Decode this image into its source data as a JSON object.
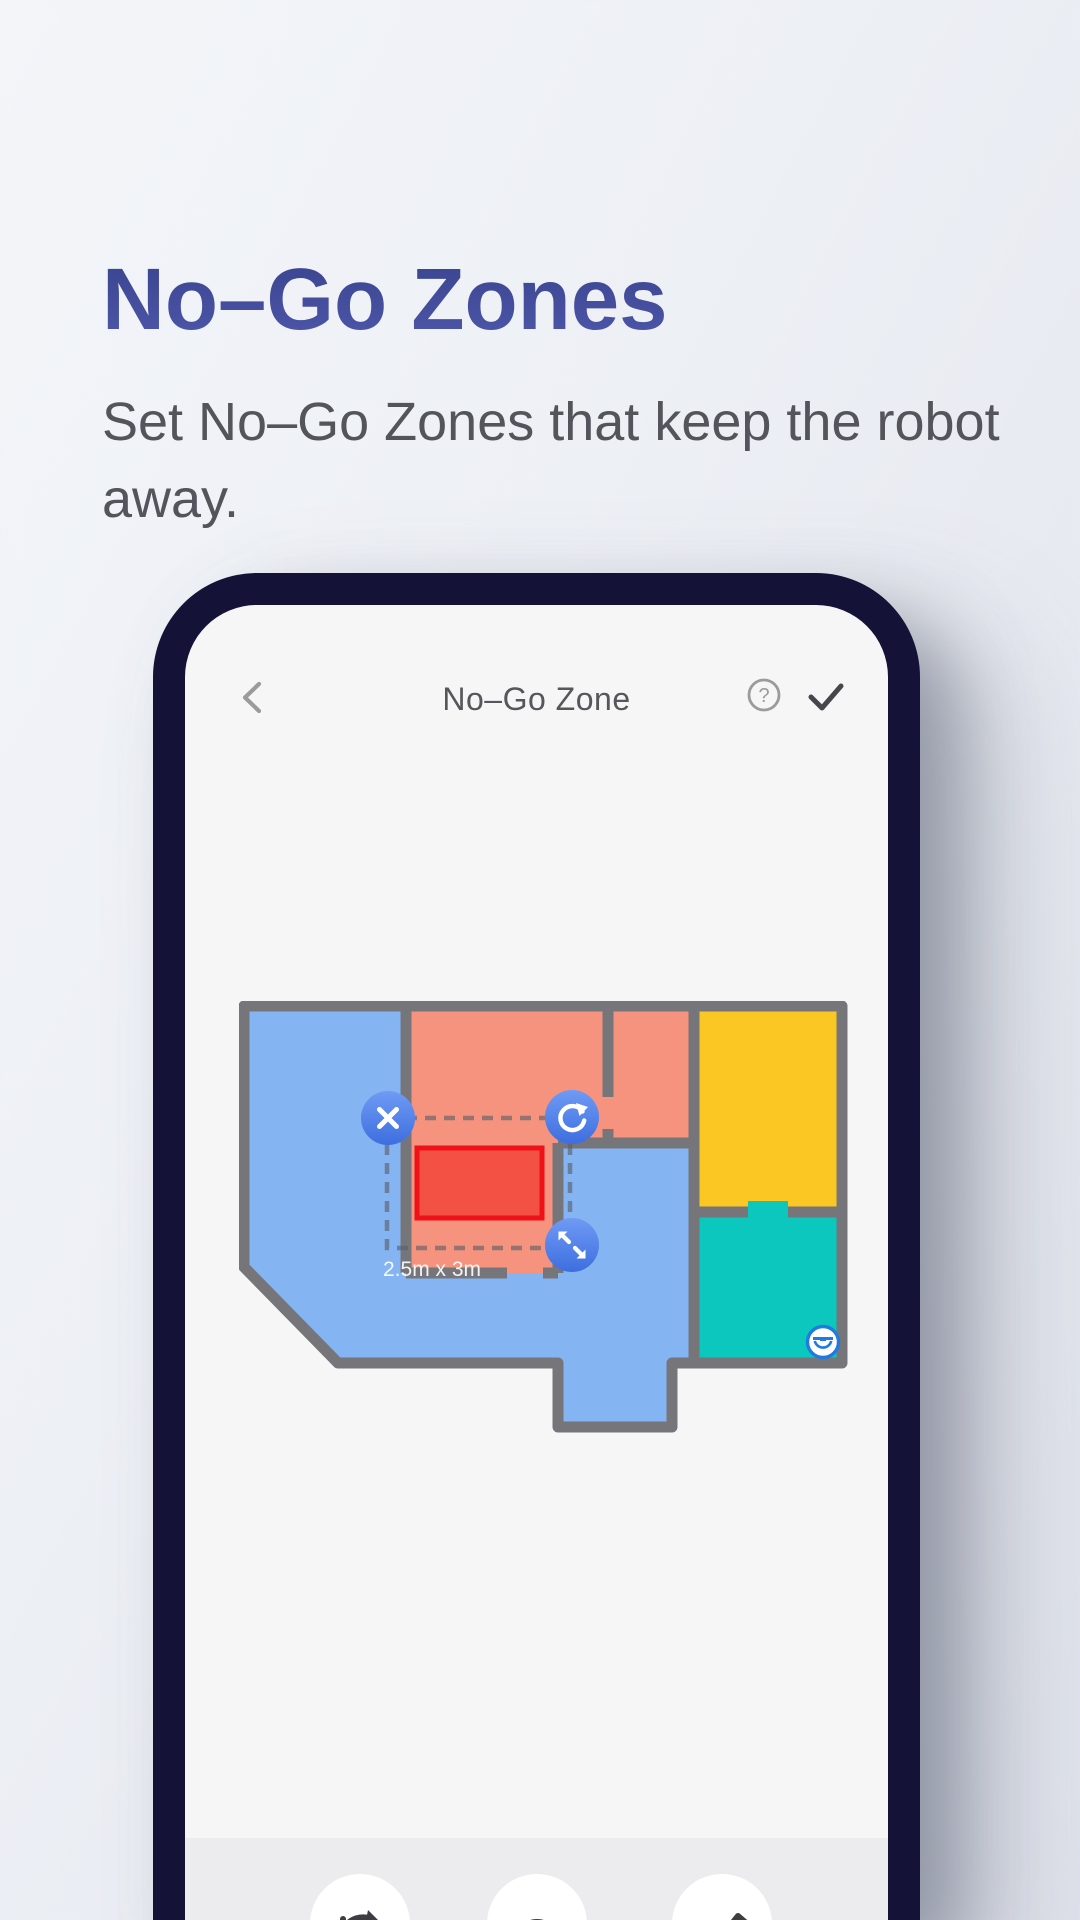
{
  "page": {
    "title": "No–Go Zones",
    "subtitle": "Set No–Go Zones that keep the robot away.",
    "colors": {
      "title_gradient_top": "#3a4590",
      "title_gradient_bottom": "#4d56a8",
      "subtitle_text": "#54555c",
      "background": "#e9ecf2"
    }
  },
  "phone": {
    "frame_color": "#141237",
    "screen_color": "#f6f6f7",
    "nav": {
      "title": "No–Go Zone",
      "back_icon": "chevron-left",
      "help_icon": "question-circle",
      "confirm_icon": "checkmark",
      "icon_color": "#9b9b9b",
      "confirm_color": "#46464b"
    },
    "map": {
      "wall_color": "#76767a",
      "rooms": {
        "living": "#84b4f1",
        "bedroom": "#f6937e",
        "study": "#fac723",
        "bathroom": "#0cc7bd"
      },
      "zone": {
        "label": "2.5m x 3m",
        "fill": "#f24b3e",
        "border": "#ee1118"
      },
      "selection_dash_color": "#5a5f69",
      "handle_gradient_top": "#6f9bf5",
      "handle_gradient_bottom": "#3e6edf",
      "handles": [
        {
          "name": "delete"
        },
        {
          "name": "rotate"
        },
        {
          "name": "resize"
        }
      ],
      "robot_color": "#1f7be0"
    },
    "toolbar": {
      "background": "#ececee",
      "buttons": [
        {
          "icon": "redirect-arrow"
        },
        {
          "icon": "circle"
        },
        {
          "icon": "pencil"
        }
      ]
    }
  }
}
